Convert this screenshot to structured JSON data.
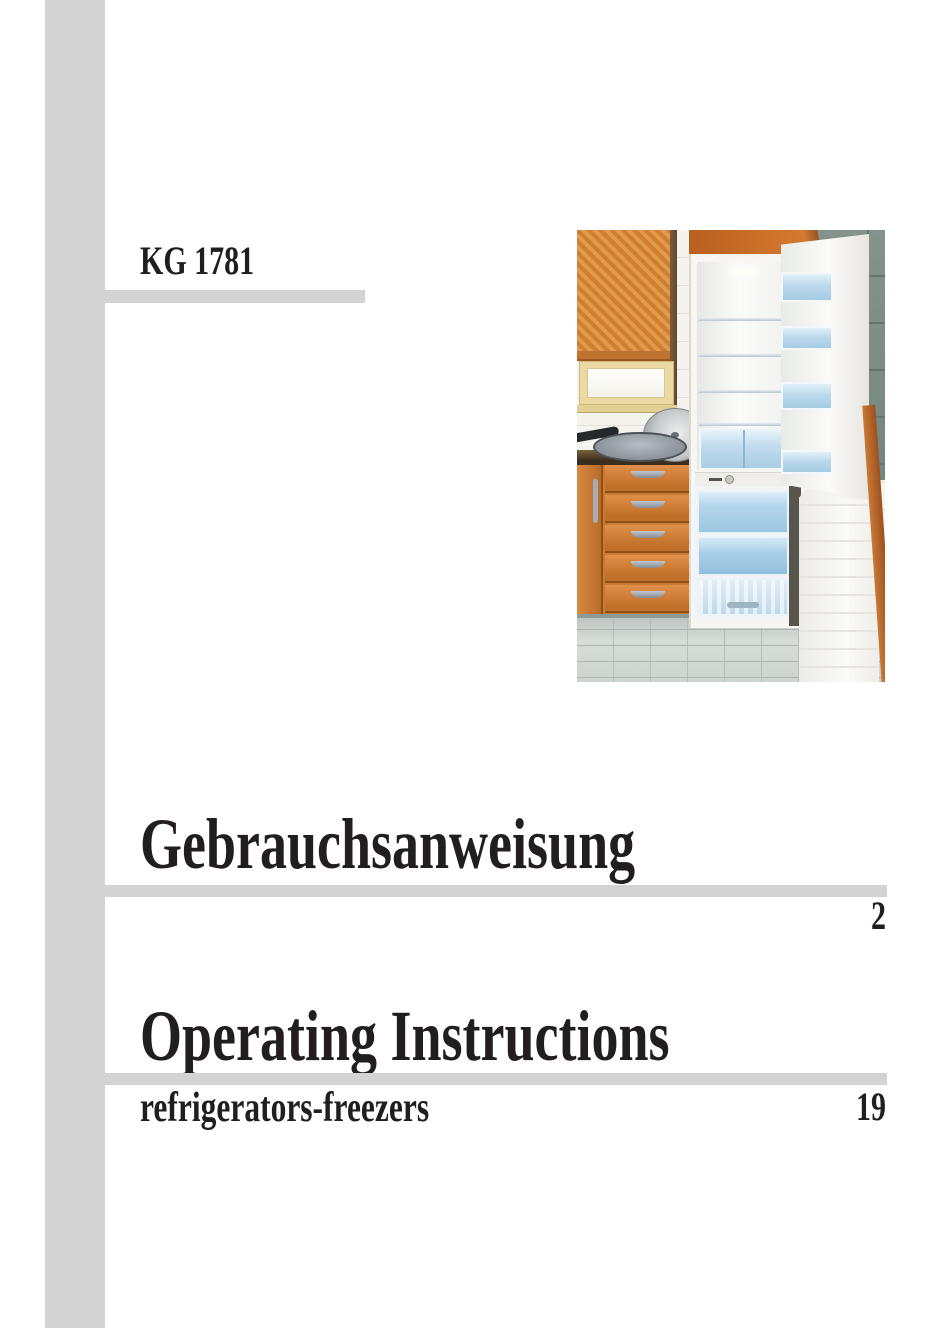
{
  "document": {
    "model_number": "KG 1781",
    "sections": {
      "german": {
        "title": "Gebrauchsanweisung",
        "page": "2"
      },
      "english": {
        "title": "Operating Instructions",
        "subtitle": "refrigerators-freezers",
        "page": "19"
      }
    }
  },
  "photo": {
    "description": "Open built-in refrigerator-freezer with blue transparent shelves in an orange kitchen with tiled walls and floor"
  },
  "colors": {
    "accent_bar_gray": "#d3d3d3",
    "text_black": "#221e1f",
    "kitchen_orange": "#c97a33",
    "tile_gray_green": "#7d8c86",
    "fridge_blue": "#bfdcef",
    "page_background": "#ffffff"
  }
}
